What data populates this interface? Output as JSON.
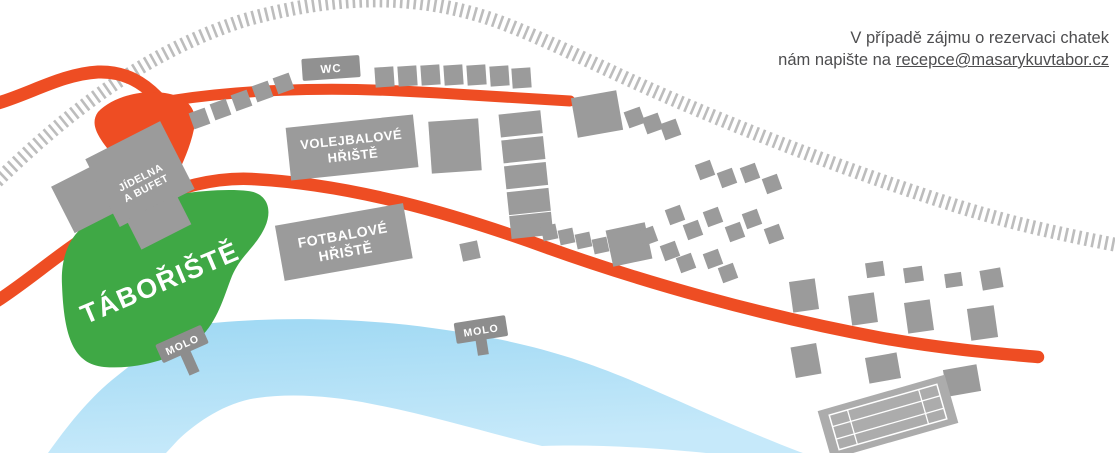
{
  "note": {
    "line1": "V případě zájmu o rezervaci chatek",
    "line2_prefix": "nám napište na",
    "email": "recepce@masarykuvtabor.cz"
  },
  "map": {
    "camp_label": "TÁBOŘIŠTĚ",
    "wc_label": "WC",
    "canteen_label_line1": "JÍDELNA",
    "canteen_label_line2": "A BUFET",
    "volleyball_label_line1": "VOLEJBALOVÉ",
    "volleyball_label_line2": "HŘIŠTĚ",
    "football_label_line1": "FOTBALOVÉ",
    "football_label_line2": "HŘIŠTĚ",
    "pier1_label": "MOLO",
    "pier2_label": "MOLO",
    "colors": {
      "road_orange": "#EE4D23",
      "building_gray": "#9B9B9B",
      "railway_gray": "#BDBDBD",
      "camp_green": "#3FA845",
      "water_blue": "#A9DEF6",
      "label_white": "#FFFFFF",
      "note_text": "#4D4D4F"
    }
  }
}
